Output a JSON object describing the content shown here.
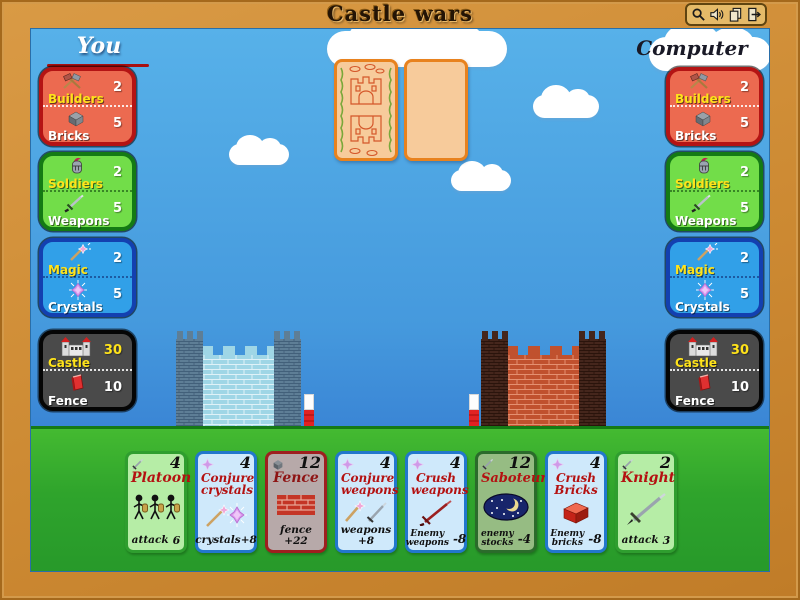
{
  "title": "Castle wars",
  "toolbar": {
    "icons": [
      "magnifier-icon",
      "sound-icon",
      "copy-icon",
      "exit-icon"
    ]
  },
  "players": {
    "you_label": "You",
    "computer_label": "Computer"
  },
  "panels": {
    "builders": {
      "r1l": "Builders",
      "r1v": "2",
      "r2l": "Bricks",
      "r2v": "5",
      "icon1": "hammers-icon",
      "icon2": "brick-icon"
    },
    "soldiers": {
      "r1l": "Soldiers",
      "r1v": "2",
      "r2l": "Weapons",
      "r2v": "5",
      "icon1": "helmet-icon",
      "icon2": "sword-icon"
    },
    "magic": {
      "r1l": "Magic",
      "r1v": "2",
      "r2l": "Crystals",
      "r2v": "5",
      "icon1": "wand-icon",
      "icon2": "crystal-icon"
    },
    "castle": {
      "r1l": "Castle",
      "r1v": "30",
      "r2l": "Fence",
      "r2v": "10",
      "icon1": "castle-icon",
      "icon2": "fence-icon"
    }
  },
  "hand": [
    {
      "name": "Platoon",
      "cost": "4",
      "cost_icon": "sword-icon",
      "effect": {
        "l1": "attack",
        "v": "6"
      }
    },
    {
      "name": "Conjure crystals",
      "cost": "4",
      "cost_icon": "crystal-icon",
      "effect": {
        "l1": "crystals+8"
      }
    },
    {
      "name": "Fence",
      "cost": "12",
      "cost_icon": "brick-icon",
      "effect": {
        "l1": "fence +22"
      }
    },
    {
      "name": "Conjure weapons",
      "cost": "4",
      "cost_icon": "crystal-icon",
      "effect": {
        "l1": "weapons +8"
      }
    },
    {
      "name": "Crush weapons",
      "cost": "4",
      "cost_icon": "crystal-icon",
      "effect": {
        "l1": "Enemy",
        "l2": "weapons",
        "v": "-8"
      }
    },
    {
      "name": "Saboteur",
      "cost": "12",
      "cost_icon": "sword-icon",
      "effect": {
        "l1": "enemy",
        "l2": "stocks",
        "v": "-4"
      }
    },
    {
      "name": "Crush Bricks",
      "cost": "4",
      "cost_icon": "crystal-icon",
      "effect": {
        "l1": "Enemy",
        "l2": "bricks",
        "v": "-8"
      }
    },
    {
      "name": "Knight",
      "cost": "2",
      "cost_icon": "sword-icon",
      "effect": {
        "l1": "attack",
        "v": "3"
      }
    }
  ],
  "colors": {
    "frame": "#cd8a33",
    "sky_top": "#57b1e9",
    "sky_bottom": "#3a85d5",
    "grass": "#2fa42c",
    "panel_red": "#ec6a50",
    "panel_green": "#72dd49",
    "panel_blue": "#31a0e8",
    "panel_dark": "#4a4a4a",
    "card_back_fill": "#f7cb9b",
    "card_back_border": "#e8821e",
    "castle_left_wall": "#9fd6e6",
    "castle_right_wall": "#c0512e",
    "card_title_red": "#b41111",
    "label_yellow": "#ffe31a"
  }
}
